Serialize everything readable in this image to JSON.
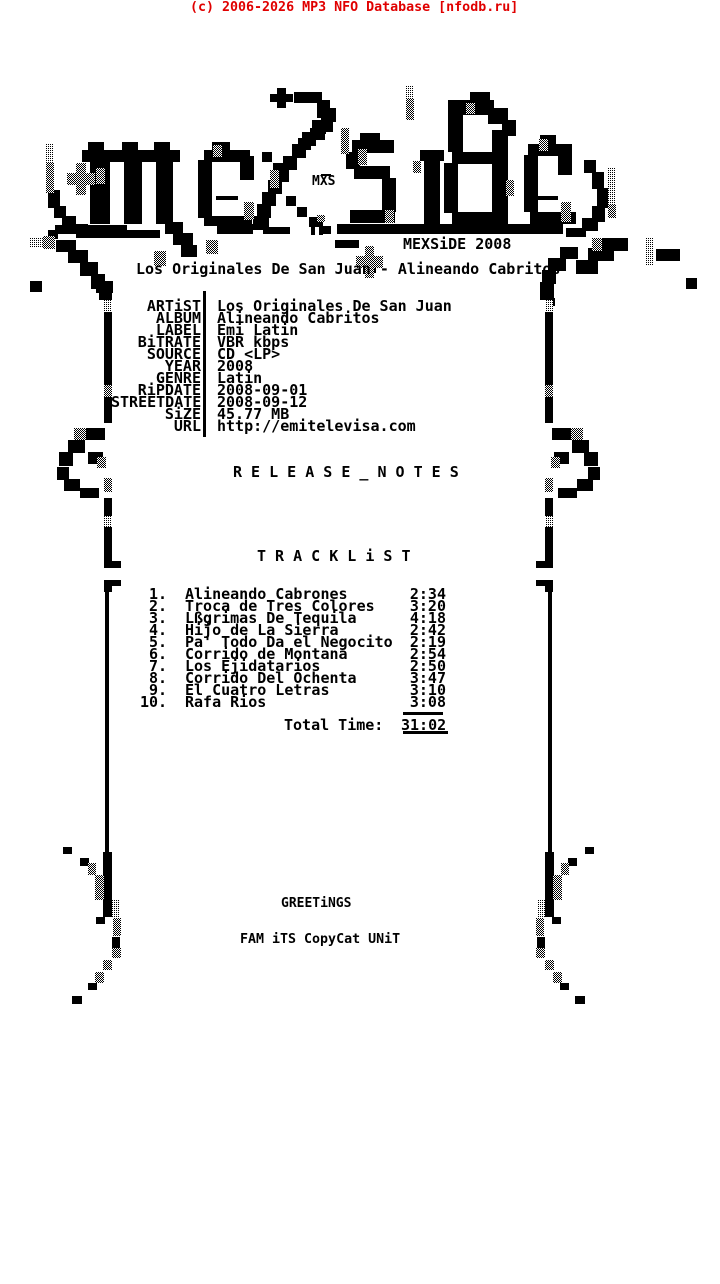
{
  "colors": {
    "ink": "#000000",
    "red": "#e00000",
    "bg": "#ffffff"
  },
  "watermark": {
    "text": "(c) 2006-2026 MP3 NFO Database [nfodb.ru]"
  },
  "logo": {
    "small_tag": "MXS",
    "brand_year": "MEXSiDE 2008"
  },
  "release_title": "Los Originales De San Juan - Alineando Cabritos",
  "info": [
    {
      "label": "ARTiST",
      "value": "Los Originales De San Juan"
    },
    {
      "label": "ALBUM",
      "value": "Alineando Cabritos"
    },
    {
      "label": "LABEL",
      "value": "Emi Latin"
    },
    {
      "label": "BiTRATE",
      "value": "VBR kbps"
    },
    {
      "label": "SOURCE",
      "value": "CD <LP>"
    },
    {
      "label": "YEAR",
      "value": "2008"
    },
    {
      "label": "GENRE",
      "value": "Latin"
    },
    {
      "label": "RiPDATE",
      "value": "2008-09-01"
    },
    {
      "label": "STREETDATE",
      "value": "2008-09-12"
    },
    {
      "label": "SiZE",
      "value": "45.77 MB"
    },
    {
      "label": "URL",
      "value": "http://emitelevisa.com"
    }
  ],
  "sections": {
    "release_notes": "R E L E A S E _ N O T E S",
    "tracklist": "T R A C K L i S T"
  },
  "tracklist": [
    {
      "num": "1.",
      "title": "Alineando Cabrones",
      "time": "2:34"
    },
    {
      "num": "2.",
      "title": "Troca de Tres Colores",
      "time": "3:20"
    },
    {
      "num": "3.",
      "title": "Lßgrimas De Tequila",
      "time": "4:18"
    },
    {
      "num": "4.",
      "title": "Hijo de La Sierra",
      "time": "2:42"
    },
    {
      "num": "5.",
      "title": "Pa' Todo Da el Negocito",
      "time": "2:19"
    },
    {
      "num": "6.",
      "title": "Corrido de Montana",
      "time": "2:54"
    },
    {
      "num": "7.",
      "title": "Los Ejidatarios",
      "time": "2:50"
    },
    {
      "num": "8.",
      "title": "Corrido Del Ochenta",
      "time": "3:47"
    },
    {
      "num": "9.",
      "title": "El Cuatro Letras",
      "time": "3:10"
    },
    {
      "num": "10.",
      "title": "Rafa Rios",
      "time": "3:08"
    }
  ],
  "total": {
    "label": "Total Time:",
    "time": "31:02"
  },
  "footer": {
    "greetings": "GREETiNGS",
    "crew": "FAM iTS CopyCat UNiT"
  },
  "artwork": {
    "black": [
      [
        48,
        190,
        12,
        18
      ],
      [
        54,
        206,
        12,
        12
      ],
      [
        62,
        216,
        14,
        10
      ],
      [
        72,
        224,
        16,
        8
      ],
      [
        48,
        230,
        10,
        9
      ],
      [
        82,
        150,
        98,
        12
      ],
      [
        88,
        142,
        16,
        10
      ],
      [
        122,
        142,
        16,
        10
      ],
      [
        154,
        142,
        16,
        10
      ],
      [
        90,
        162,
        20,
        62
      ],
      [
        124,
        162,
        18,
        62
      ],
      [
        156,
        162,
        17,
        62
      ],
      [
        77,
        175,
        9,
        9
      ],
      [
        212,
        142,
        18,
        10
      ],
      [
        204,
        150,
        46,
        12
      ],
      [
        198,
        160,
        14,
        58
      ],
      [
        240,
        156,
        14,
        24
      ],
      [
        204,
        216,
        48,
        10
      ],
      [
        216,
        196,
        22,
        4
      ],
      [
        277,
        88,
        9,
        20
      ],
      [
        270,
        94,
        23,
        8
      ],
      [
        294,
        92,
        28,
        11
      ],
      [
        317,
        100,
        13,
        18
      ],
      [
        321,
        116,
        12,
        16
      ],
      [
        310,
        128,
        15,
        12
      ],
      [
        298,
        138,
        13,
        12
      ],
      [
        322,
        108,
        14,
        14
      ],
      [
        312,
        120,
        14,
        14
      ],
      [
        302,
        132,
        14,
        14
      ],
      [
        292,
        144,
        14,
        14
      ],
      [
        283,
        156,
        14,
        14
      ],
      [
        275,
        168,
        14,
        14
      ],
      [
        268,
        180,
        14,
        14
      ],
      [
        262,
        192,
        14,
        14
      ],
      [
        257,
        204,
        14,
        14
      ],
      [
        253,
        216,
        16,
        14
      ],
      [
        262,
        152,
        10,
        10
      ],
      [
        273,
        163,
        10,
        10
      ],
      [
        286,
        196,
        10,
        10
      ],
      [
        297,
        207,
        10,
        10
      ],
      [
        309,
        217,
        10,
        10
      ],
      [
        321,
        226,
        10,
        8
      ],
      [
        360,
        133,
        20,
        9
      ],
      [
        352,
        140,
        42,
        13
      ],
      [
        346,
        152,
        14,
        17
      ],
      [
        354,
        166,
        36,
        13
      ],
      [
        382,
        178,
        14,
        34
      ],
      [
        350,
        210,
        45,
        13
      ],
      [
        420,
        150,
        24,
        11
      ],
      [
        424,
        160,
        16,
        64
      ],
      [
        470,
        92,
        20,
        11
      ],
      [
        448,
        100,
        46,
        15
      ],
      [
        448,
        114,
        15,
        38
      ],
      [
        488,
        108,
        20,
        16
      ],
      [
        502,
        120,
        14,
        16
      ],
      [
        452,
        152,
        40,
        12
      ],
      [
        444,
        163,
        14,
        50
      ],
      [
        452,
        212,
        44,
        12
      ],
      [
        492,
        130,
        16,
        94
      ],
      [
        540,
        135,
        16,
        10
      ],
      [
        528,
        144,
        44,
        12
      ],
      [
        524,
        155,
        14,
        57
      ],
      [
        558,
        150,
        14,
        25
      ],
      [
        530,
        212,
        46,
        12
      ],
      [
        536,
        196,
        22,
        4
      ],
      [
        584,
        160,
        12,
        13
      ],
      [
        592,
        172,
        12,
        17
      ],
      [
        597,
        188,
        12,
        20
      ],
      [
        592,
        206,
        13,
        16
      ],
      [
        582,
        218,
        16,
        13
      ],
      [
        566,
        228,
        20,
        9
      ],
      [
        55,
        225,
        72,
        9
      ],
      [
        76,
        230,
        84,
        8
      ],
      [
        165,
        222,
        18,
        12
      ],
      [
        173,
        233,
        20,
        12
      ],
      [
        181,
        245,
        16,
        12
      ],
      [
        217,
        224,
        36,
        10
      ],
      [
        263,
        227,
        27,
        7
      ],
      [
        311,
        221,
        4,
        14
      ],
      [
        319,
        221,
        4,
        14
      ],
      [
        337,
        224,
        226,
        10
      ],
      [
        335,
        240,
        24,
        8
      ],
      [
        365,
        261,
        11,
        12
      ],
      [
        321,
        174,
        10,
        2
      ],
      [
        56,
        240,
        20,
        12
      ],
      [
        68,
        250,
        20,
        13
      ],
      [
        80,
        262,
        18,
        14
      ],
      [
        91,
        274,
        14,
        15
      ],
      [
        99,
        287,
        13,
        13
      ],
      [
        30,
        281,
        12,
        11
      ],
      [
        96,
        281,
        17,
        12
      ],
      [
        600,
        238,
        28,
        13
      ],
      [
        588,
        248,
        26,
        13
      ],
      [
        576,
        260,
        22,
        14
      ],
      [
        560,
        247,
        18,
        12
      ],
      [
        548,
        258,
        18,
        13
      ],
      [
        542,
        270,
        14,
        14
      ],
      [
        540,
        282,
        14,
        18
      ],
      [
        545,
        298,
        10,
        8
      ],
      [
        656,
        249,
        24,
        12
      ],
      [
        686,
        278,
        11,
        11
      ],
      [
        203,
        291,
        3,
        146
      ],
      [
        104,
        312,
        8,
        73
      ],
      [
        104,
        397,
        8,
        26
      ],
      [
        86,
        428,
        19,
        12
      ],
      [
        68,
        440,
        17,
        13
      ],
      [
        59,
        452,
        14,
        14
      ],
      [
        88,
        452,
        15,
        12
      ],
      [
        57,
        467,
        12,
        13
      ],
      [
        64,
        479,
        16,
        12
      ],
      [
        80,
        488,
        19,
        10
      ],
      [
        104,
        498,
        8,
        18
      ],
      [
        104,
        527,
        8,
        24
      ],
      [
        104,
        551,
        8,
        17
      ],
      [
        112,
        561,
        9,
        7
      ],
      [
        104,
        580,
        8,
        12
      ],
      [
        112,
        580,
        9,
        6
      ],
      [
        105,
        592,
        4,
        260
      ],
      [
        103,
        852,
        9,
        65
      ],
      [
        63,
        847,
        9,
        7
      ],
      [
        80,
        858,
        9,
        8
      ],
      [
        96,
        917,
        9,
        7
      ],
      [
        112,
        937,
        8,
        11
      ],
      [
        88,
        983,
        9,
        7
      ],
      [
        72,
        996,
        10,
        8
      ],
      [
        545,
        312,
        8,
        73
      ],
      [
        545,
        397,
        8,
        26
      ],
      [
        552,
        428,
        19,
        12
      ],
      [
        572,
        440,
        17,
        13
      ],
      [
        584,
        452,
        14,
        14
      ],
      [
        554,
        452,
        15,
        12
      ],
      [
        588,
        467,
        12,
        13
      ],
      [
        577,
        479,
        16,
        12
      ],
      [
        558,
        488,
        19,
        10
      ],
      [
        545,
        498,
        8,
        18
      ],
      [
        545,
        527,
        8,
        24
      ],
      [
        545,
        551,
        8,
        17
      ],
      [
        536,
        561,
        9,
        7
      ],
      [
        545,
        580,
        8,
        12
      ],
      [
        536,
        580,
        9,
        6
      ],
      [
        548,
        592,
        4,
        260
      ],
      [
        545,
        852,
        9,
        65
      ],
      [
        585,
        847,
        9,
        7
      ],
      [
        568,
        858,
        9,
        8
      ],
      [
        552,
        917,
        9,
        7
      ],
      [
        537,
        937,
        8,
        11
      ],
      [
        560,
        983,
        9,
        7
      ],
      [
        575,
        996,
        10,
        8
      ],
      [
        403,
        712,
        40,
        3
      ],
      [
        403,
        731,
        45,
        3
      ]
    ],
    "dark": [
      [
        46,
        163,
        8,
        30
      ],
      [
        76,
        163,
        10,
        32
      ],
      [
        67,
        173,
        28,
        12
      ],
      [
        96,
        168,
        9,
        16
      ],
      [
        213,
        145,
        9,
        12
      ],
      [
        244,
        202,
        10,
        18
      ],
      [
        341,
        128,
        8,
        26
      ],
      [
        270,
        170,
        9,
        18
      ],
      [
        358,
        149,
        9,
        16
      ],
      [
        385,
        210,
        9,
        13
      ],
      [
        406,
        98,
        8,
        22
      ],
      [
        413,
        161,
        8,
        12
      ],
      [
        506,
        180,
        8,
        16
      ],
      [
        466,
        103,
        9,
        11
      ],
      [
        539,
        139,
        9,
        12
      ],
      [
        561,
        202,
        10,
        20
      ],
      [
        608,
        204,
        8,
        14
      ],
      [
        206,
        240,
        12,
        14
      ],
      [
        317,
        215,
        8,
        7
      ],
      [
        365,
        246,
        9,
        32
      ],
      [
        356,
        256,
        27,
        12
      ],
      [
        43,
        236,
        12,
        13
      ],
      [
        154,
        251,
        12,
        15
      ],
      [
        592,
        238,
        10,
        13
      ],
      [
        104,
        385,
        8,
        12
      ],
      [
        74,
        428,
        12,
        12
      ],
      [
        97,
        457,
        9,
        11
      ],
      [
        104,
        478,
        8,
        14
      ],
      [
        88,
        863,
        8,
        12
      ],
      [
        95,
        875,
        9,
        25
      ],
      [
        113,
        918,
        8,
        18
      ],
      [
        112,
        948,
        9,
        10
      ],
      [
        103,
        960,
        9,
        10
      ],
      [
        95,
        972,
        9,
        11
      ],
      [
        545,
        385,
        8,
        12
      ],
      [
        571,
        428,
        12,
        12
      ],
      [
        551,
        457,
        9,
        11
      ],
      [
        545,
        478,
        8,
        14
      ],
      [
        561,
        863,
        8,
        12
      ],
      [
        553,
        875,
        9,
        25
      ],
      [
        536,
        918,
        8,
        18
      ],
      [
        536,
        948,
        9,
        10
      ],
      [
        545,
        960,
        9,
        10
      ],
      [
        553,
        972,
        9,
        11
      ]
    ],
    "light": [
      [
        46,
        143,
        8,
        20
      ],
      [
        406,
        85,
        8,
        13
      ],
      [
        608,
        168,
        8,
        36
      ],
      [
        30,
        238,
        13,
        10
      ],
      [
        645,
        238,
        9,
        28
      ],
      [
        104,
        300,
        8,
        12
      ],
      [
        545,
        300,
        8,
        12
      ],
      [
        104,
        516,
        8,
        11
      ],
      [
        545,
        516,
        8,
        11
      ],
      [
        112,
        900,
        8,
        18
      ],
      [
        537,
        900,
        8,
        18
      ]
    ]
  }
}
